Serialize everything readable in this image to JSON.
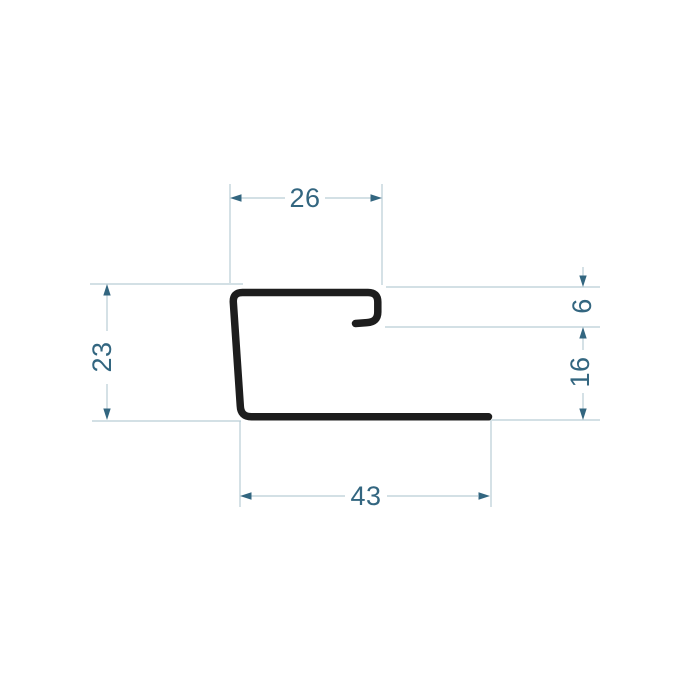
{
  "drawing": {
    "type": "profile-cross-section",
    "description": "Technical drawing of a J-shaped edge profile cross section with five dimensions",
    "dimensions": {
      "top_width": "26",
      "left_height": "23",
      "hook_height": "6",
      "right_height": "16",
      "bottom_width": "43"
    },
    "colors": {
      "background": "#ffffff",
      "profile_stroke": "#1d1d1d",
      "dimension_lines": "#b9cdd5",
      "dimension_text_and_arrows": "#336680"
    }
  }
}
